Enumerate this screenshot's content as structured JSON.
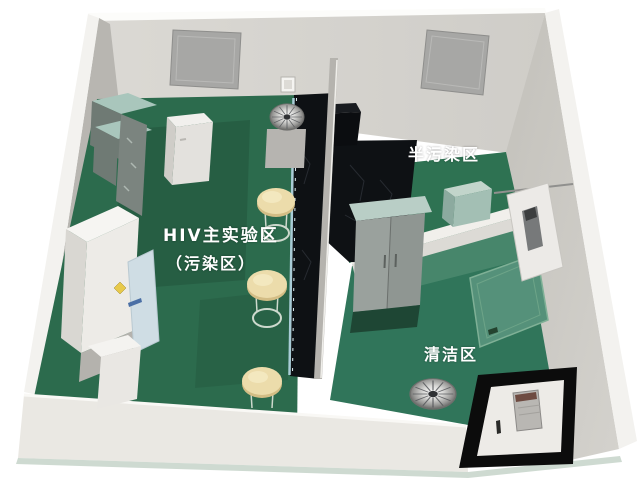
{
  "scene": {
    "zones": {
      "main": {
        "label": "HIV主实验区",
        "sublabel": "（污染区）"
      },
      "semi": {
        "label": "半污染区"
      },
      "clean": {
        "label": "清洁区"
      }
    }
  },
  "colors": {
    "background": "#ffffff",
    "floor_main": "#2c6b4d",
    "floor_semi": "#2e7252",
    "floor_clean": "#30755a",
    "floor_light": "#4b8a6e",
    "wall_back": "#d6d4cf",
    "wall_right": "#c9c7c1",
    "wall_white": "#f3f2ef",
    "wall_inner_gray": "#b8b6b1",
    "front_wall": "#eae8e3",
    "bench_black": "#0e1114",
    "divider_gray": "#b5b3ae",
    "cabinet_teal": "#a9c6bc",
    "cabinet_gray": "#8f9693",
    "stool_cream": "#ecdcab",
    "window_gray": "#a7a7a5",
    "door_frame_black": "#0c0c0c",
    "hazard_yellow": "#e8c94a",
    "label_text": "#ffffff"
  }
}
